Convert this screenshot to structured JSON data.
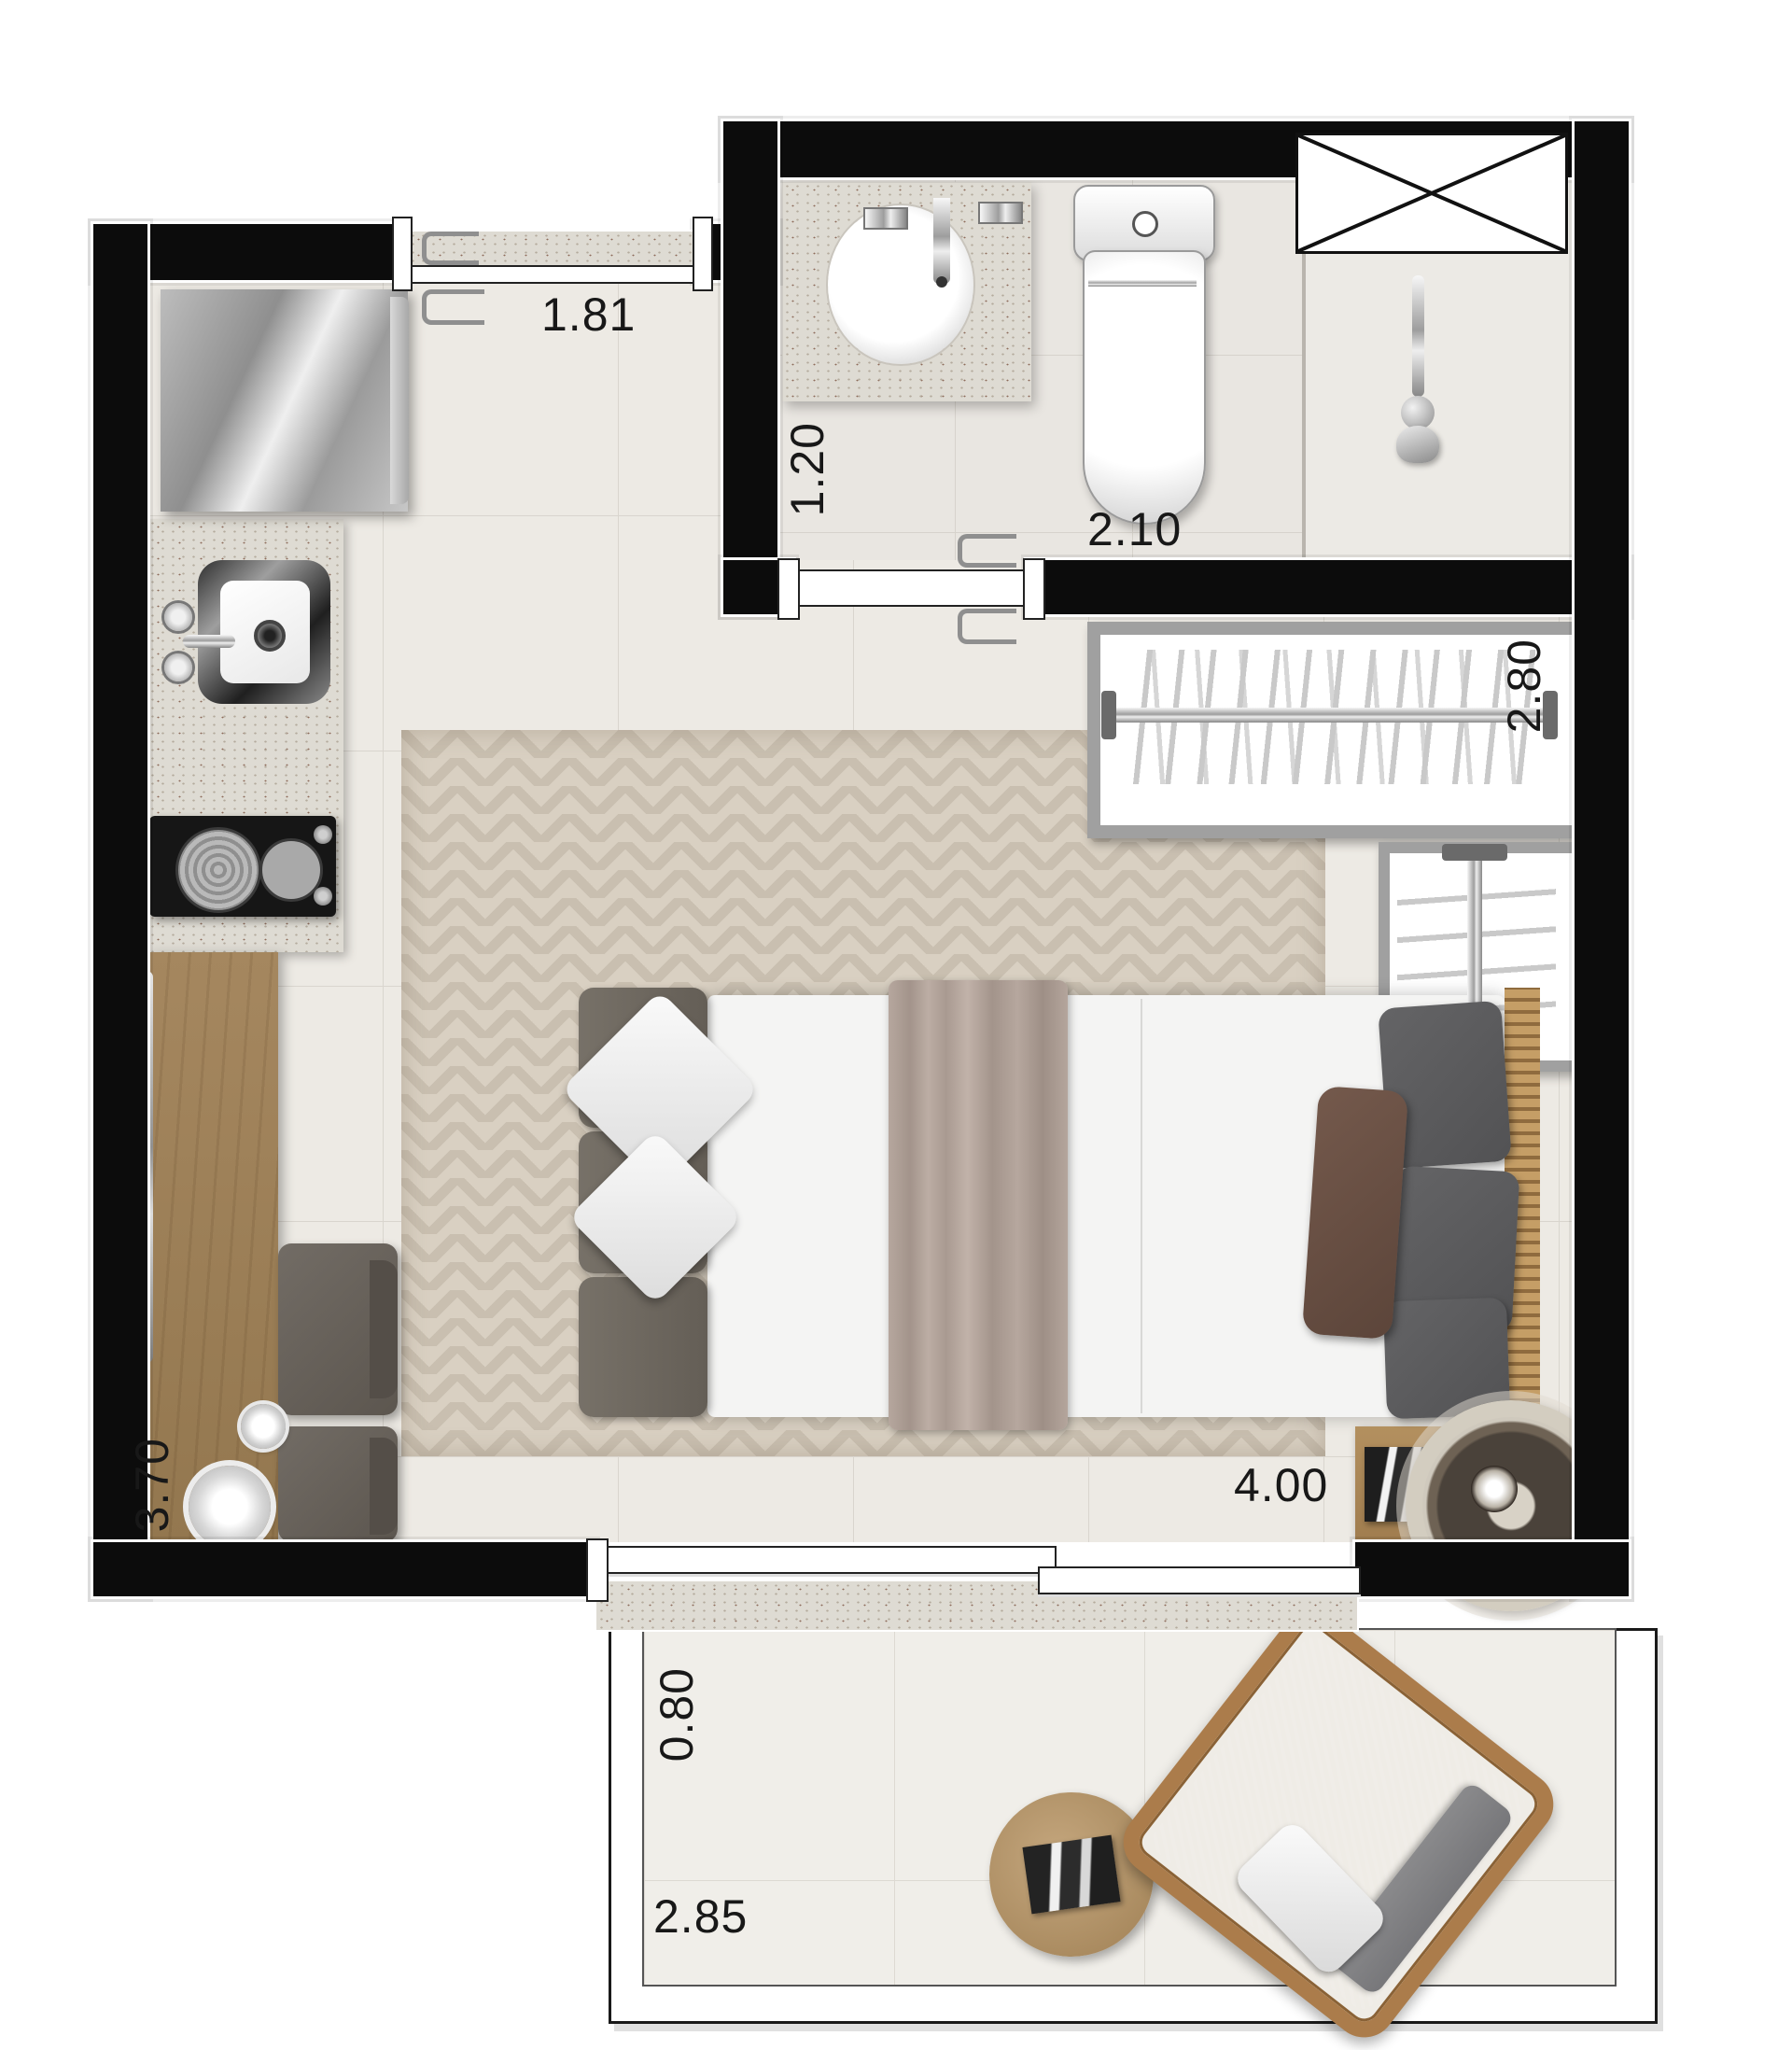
{
  "dimensions": {
    "window_top": "1.81",
    "bath_depth": "1.20",
    "bath_width": "2.10",
    "closet_width": "2.80",
    "room_depth": "3.70",
    "room_width": "4.00",
    "balcony_depth": "0.80",
    "balcony_width": "2.85"
  },
  "colors": {
    "wall": "#0c0c0c",
    "floor_tile": "#edeae4",
    "rug_base": "#c9bfb0",
    "rug_stripe": "#d9d0c2",
    "granite": "#dedbd3",
    "wood_counter": "#a08059",
    "bed_headboard": "#6f6a62",
    "bed_blanket": "#b1a299",
    "dark_cushion": "#5d5c5e",
    "brown_pillow": "#6a5044",
    "wicker_chair": "#ab7c4b"
  }
}
